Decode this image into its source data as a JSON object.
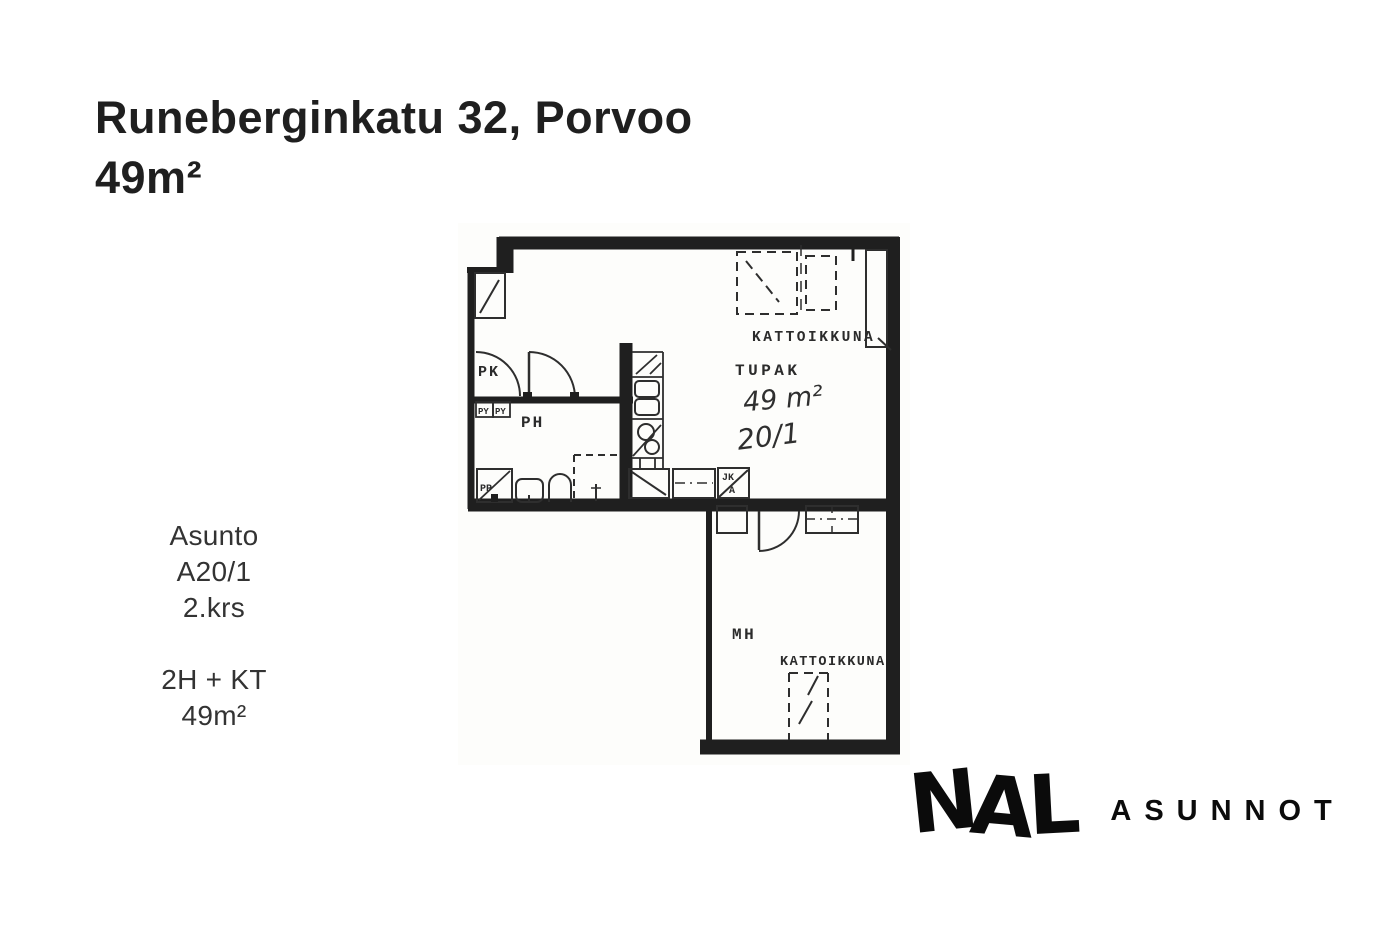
{
  "header": {
    "title": "Runeberginkatu 32, Porvoo",
    "subtitle": "49m²"
  },
  "info": {
    "lines": [
      "Asunto",
      "A20/1",
      "2.krs"
    ],
    "lines2": [
      "2H + KT",
      "49m²"
    ]
  },
  "floorplan": {
    "labels": {
      "closet": "PK",
      "laundry1": "PY",
      "laundry2": "PY",
      "bathroom": "PH",
      "washer": "PP",
      "living_kitchen": "TUPAK",
      "area_handwritten": "49 m²",
      "unit_handwritten": "20/1",
      "skylight_top": "KATTOIKKUNA",
      "fridge_line1": "JK",
      "fridge_line2": "A",
      "bedroom": "MH",
      "skylight_bottom": "KATTOIKKUNA"
    }
  },
  "logo": {
    "letters": [
      "N",
      "A",
      "L"
    ],
    "suffix": "ASUNNOT"
  },
  "colors": {
    "title_text": "#1f1f1f",
    "info_text": "#333333",
    "plan_wall": "#1f1f1f",
    "plan_line": "#2e2e2e",
    "plan_bg": "#fdfdfb",
    "logo": "#0b0b0b"
  }
}
